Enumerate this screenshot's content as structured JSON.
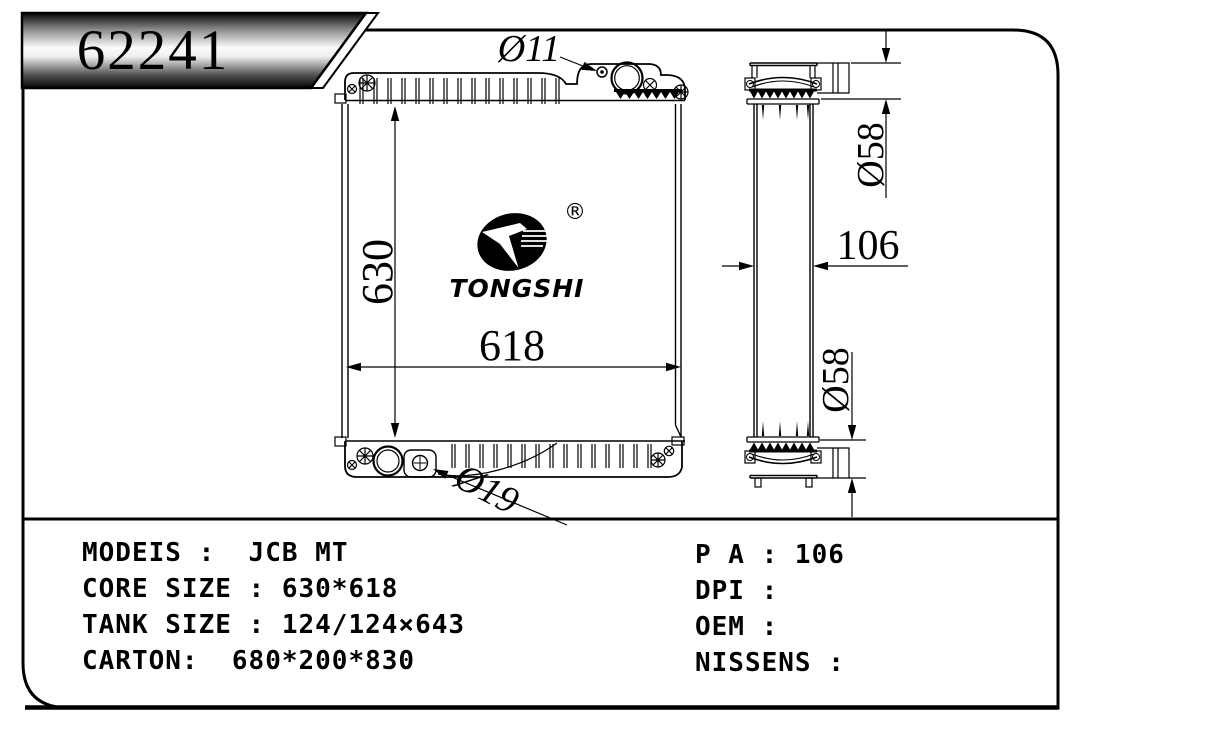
{
  "banner": {
    "part_number": "62241"
  },
  "logo": {
    "brand": "TONGSHI",
    "registered_mark": "®"
  },
  "dimensions": {
    "front_view": {
      "core_height": "630",
      "core_width": "618",
      "filler_hole": "Ø11",
      "drain_hole": "Ø19"
    },
    "side_view": {
      "top_pipe": "Ø58",
      "bottom_pipe": "Ø58",
      "depth": "106"
    }
  },
  "spec_table": {
    "left_rows": [
      {
        "label": "MODEIS :  ",
        "value": "JCB MT"
      },
      {
        "label": "CORE SIZE : ",
        "value": "630*618"
      },
      {
        "label": "TANK SIZE : ",
        "value": "124/124×643"
      },
      {
        "label": "CARTON:  ",
        "value": "680*200*830"
      }
    ],
    "right_rows": [
      {
        "label": "P A : ",
        "value": "106"
      },
      {
        "label": "DPI : ",
        "value": ""
      },
      {
        "label": "OEM : ",
        "value": ""
      },
      {
        "label": "NISSENS : ",
        "value": ""
      }
    ]
  }
}
